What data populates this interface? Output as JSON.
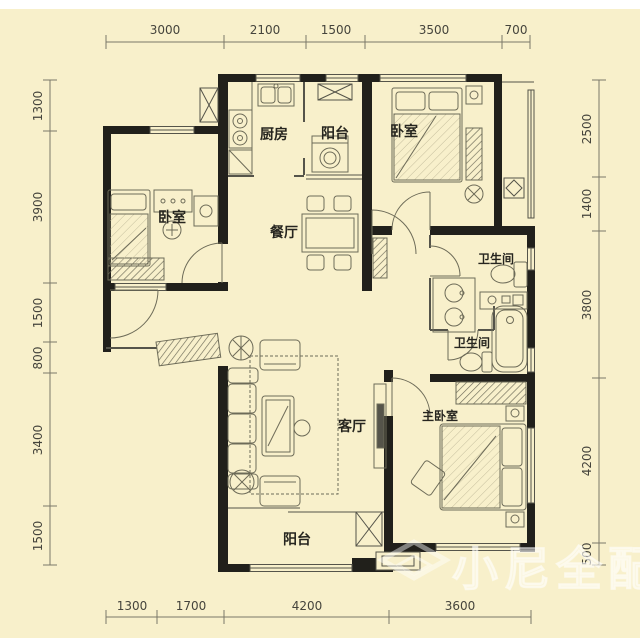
{
  "title": "apartment-floor-plan",
  "rooms": {
    "bedroom_left": "卧室",
    "kitchen": "厨房",
    "balcony_top": "阳台",
    "bedroom_top_right": "卧室",
    "dining": "餐厅",
    "bath_1": "卫生间",
    "bath_2": "卫生间",
    "living": "客厅",
    "master_bedroom": "主卧室",
    "balcony_bottom": "阳台"
  },
  "dimensions": {
    "top": [
      "3000",
      "2100",
      "1500",
      "3500",
      "700"
    ],
    "bottom": [
      "1300",
      "1700",
      "4200",
      "3600"
    ],
    "left": [
      "1300",
      "3900",
      "1500",
      "800",
      "3400",
      "1500"
    ],
    "right": [
      "2500",
      "1400",
      "3800",
      "4200",
      "500"
    ]
  },
  "watermark": {
    "text": "小尼全配"
  },
  "colors": {
    "background": "#f8f0cb",
    "wall": "#21201b",
    "furniture_line": "#6d6b58",
    "dimension_text": "#45443c",
    "watermark": "#ffffff"
  }
}
